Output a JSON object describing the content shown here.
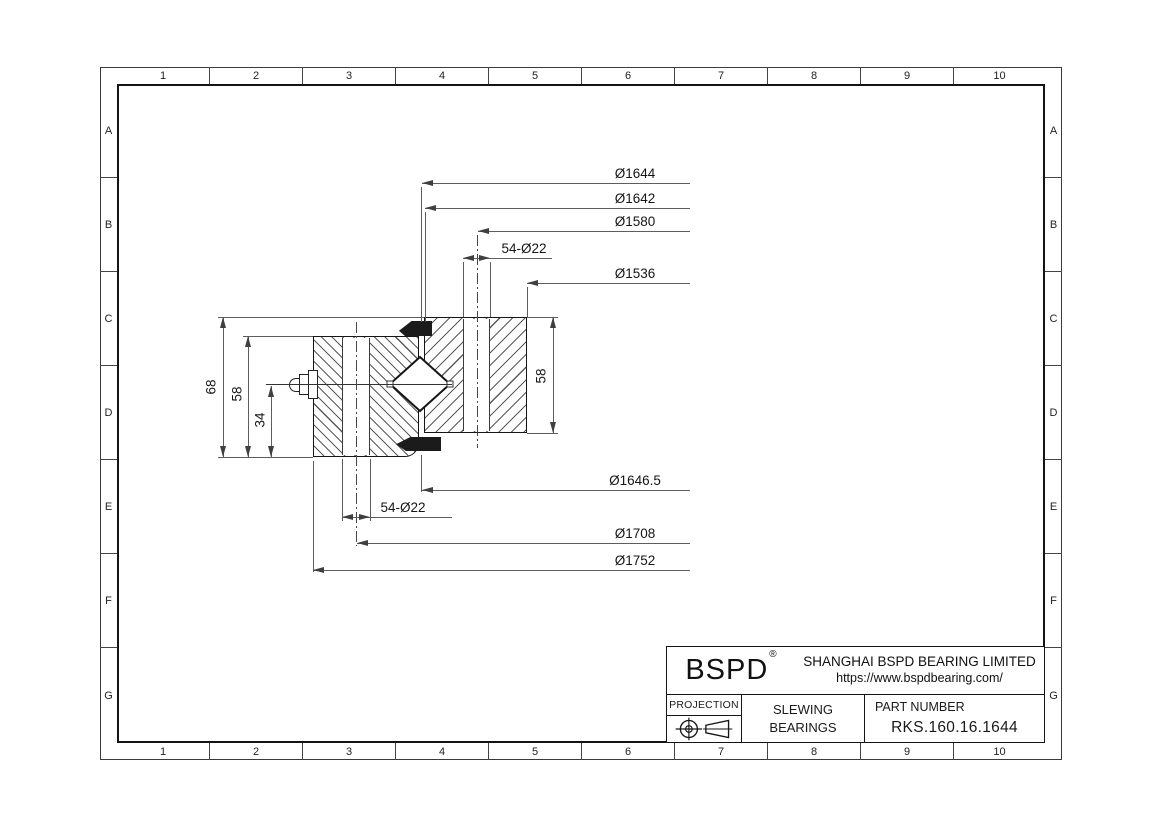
{
  "grid": {
    "cols": [
      "1",
      "2",
      "3",
      "4",
      "5",
      "6",
      "7",
      "8",
      "9",
      "10"
    ],
    "rows": [
      "A",
      "B",
      "C",
      "D",
      "E",
      "F",
      "G"
    ]
  },
  "dims": {
    "d1644": "Ø1644",
    "d1642": "Ø1642",
    "d1580": "Ø1580",
    "dbolt_top": "54-Ø22",
    "d1536": "Ø1536",
    "d1646_5": "Ø1646.5",
    "dbolt_bottom": "54-Ø22",
    "d1708": "Ø1708",
    "d1752": "Ø1752",
    "h68": "68",
    "h58_outer": "58",
    "h34": "34",
    "h58_inner": "58"
  },
  "title_block": {
    "logo": "BSPD",
    "logo_reg": "®",
    "company": "SHANGHAI BSPD BEARING LIMITED",
    "website": "https://www.bspdbearing.com/",
    "projection_label": "PROJECTION",
    "product_line1": "SLEWING",
    "product_line2": "BEARINGS",
    "part_number_label": "PART  NUMBER",
    "part_number": "RKS.160.16.1644"
  },
  "colors": {
    "line": "#161616",
    "dim_line": "#5d5d5d",
    "seal_fill": "#1b1b1b",
    "background": "#ffffff"
  }
}
